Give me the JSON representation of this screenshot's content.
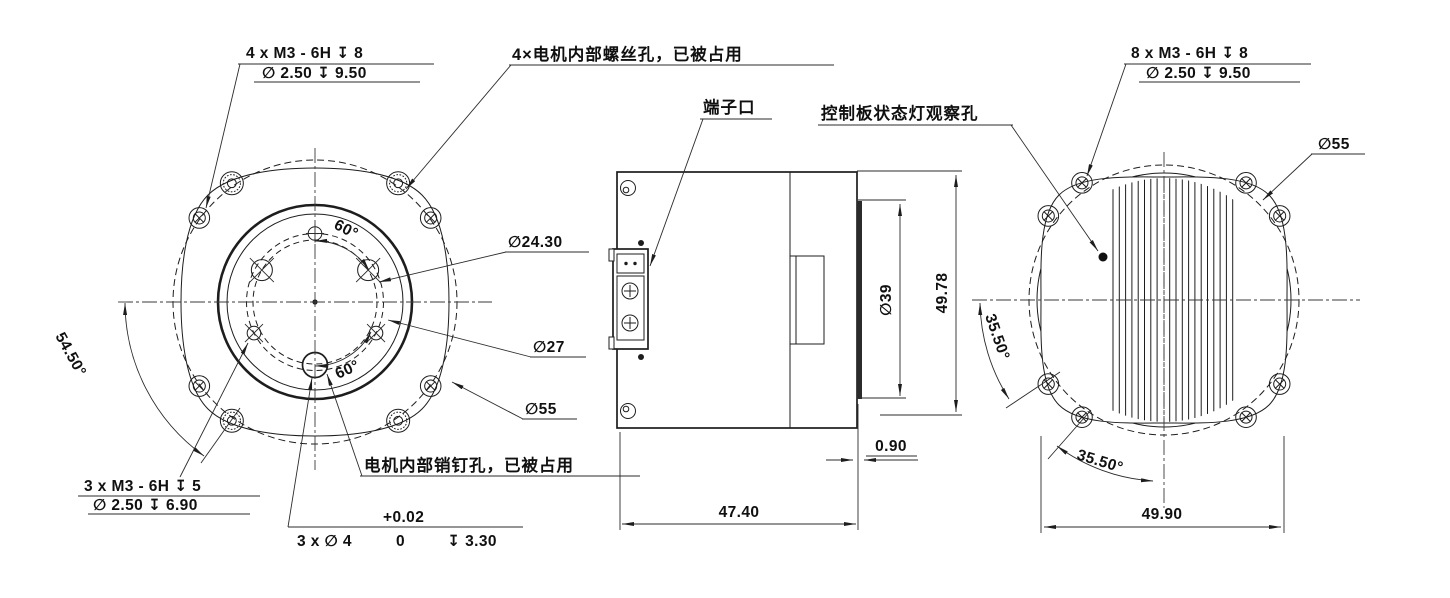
{
  "callouts": {
    "front_top": {
      "line1": "4 x  M3 - 6H ↧ 8",
      "line2": "∅ 2.50 ↧ 9.50"
    },
    "motor_screw_note": "4×电机内部螺丝孔，已被占用",
    "terminal": "端子口",
    "status_light": "控制板状态灯观察孔",
    "back_top": {
      "line1": "8 x  M3 - 6H ↧ 8",
      "line2": "∅ 2.50 ↧ 9.50"
    },
    "front_bottom": {
      "line1": "3 x  M3 - 6H ↧ 5",
      "line2": "∅ 2.50 ↧ 6.90"
    },
    "pin_note": "电机内部销钉孔，已被占用",
    "pin_hole": {
      "prefix": "3 x ∅ 4",
      "tol_lower": "0",
      "tol_upper": "+0.02",
      "suffix": "↧ 3.30"
    }
  },
  "dimensions": {
    "dia_24_30": "∅24.30",
    "dia_27": "∅27",
    "dia_55_front": "∅55",
    "dia_55_back": "∅55",
    "angle_60_top": "60°",
    "angle_60_bottom": "60°",
    "angle_54_50": "54.50°",
    "width_47_40": "47.40",
    "offset_0_90": "0.90",
    "dia_39": "∅39",
    "height_49_78": "49.78",
    "angle_35_50_left": "35.50°",
    "angle_35_50_bottom": "35.50°",
    "width_49_90": "49.90"
  }
}
